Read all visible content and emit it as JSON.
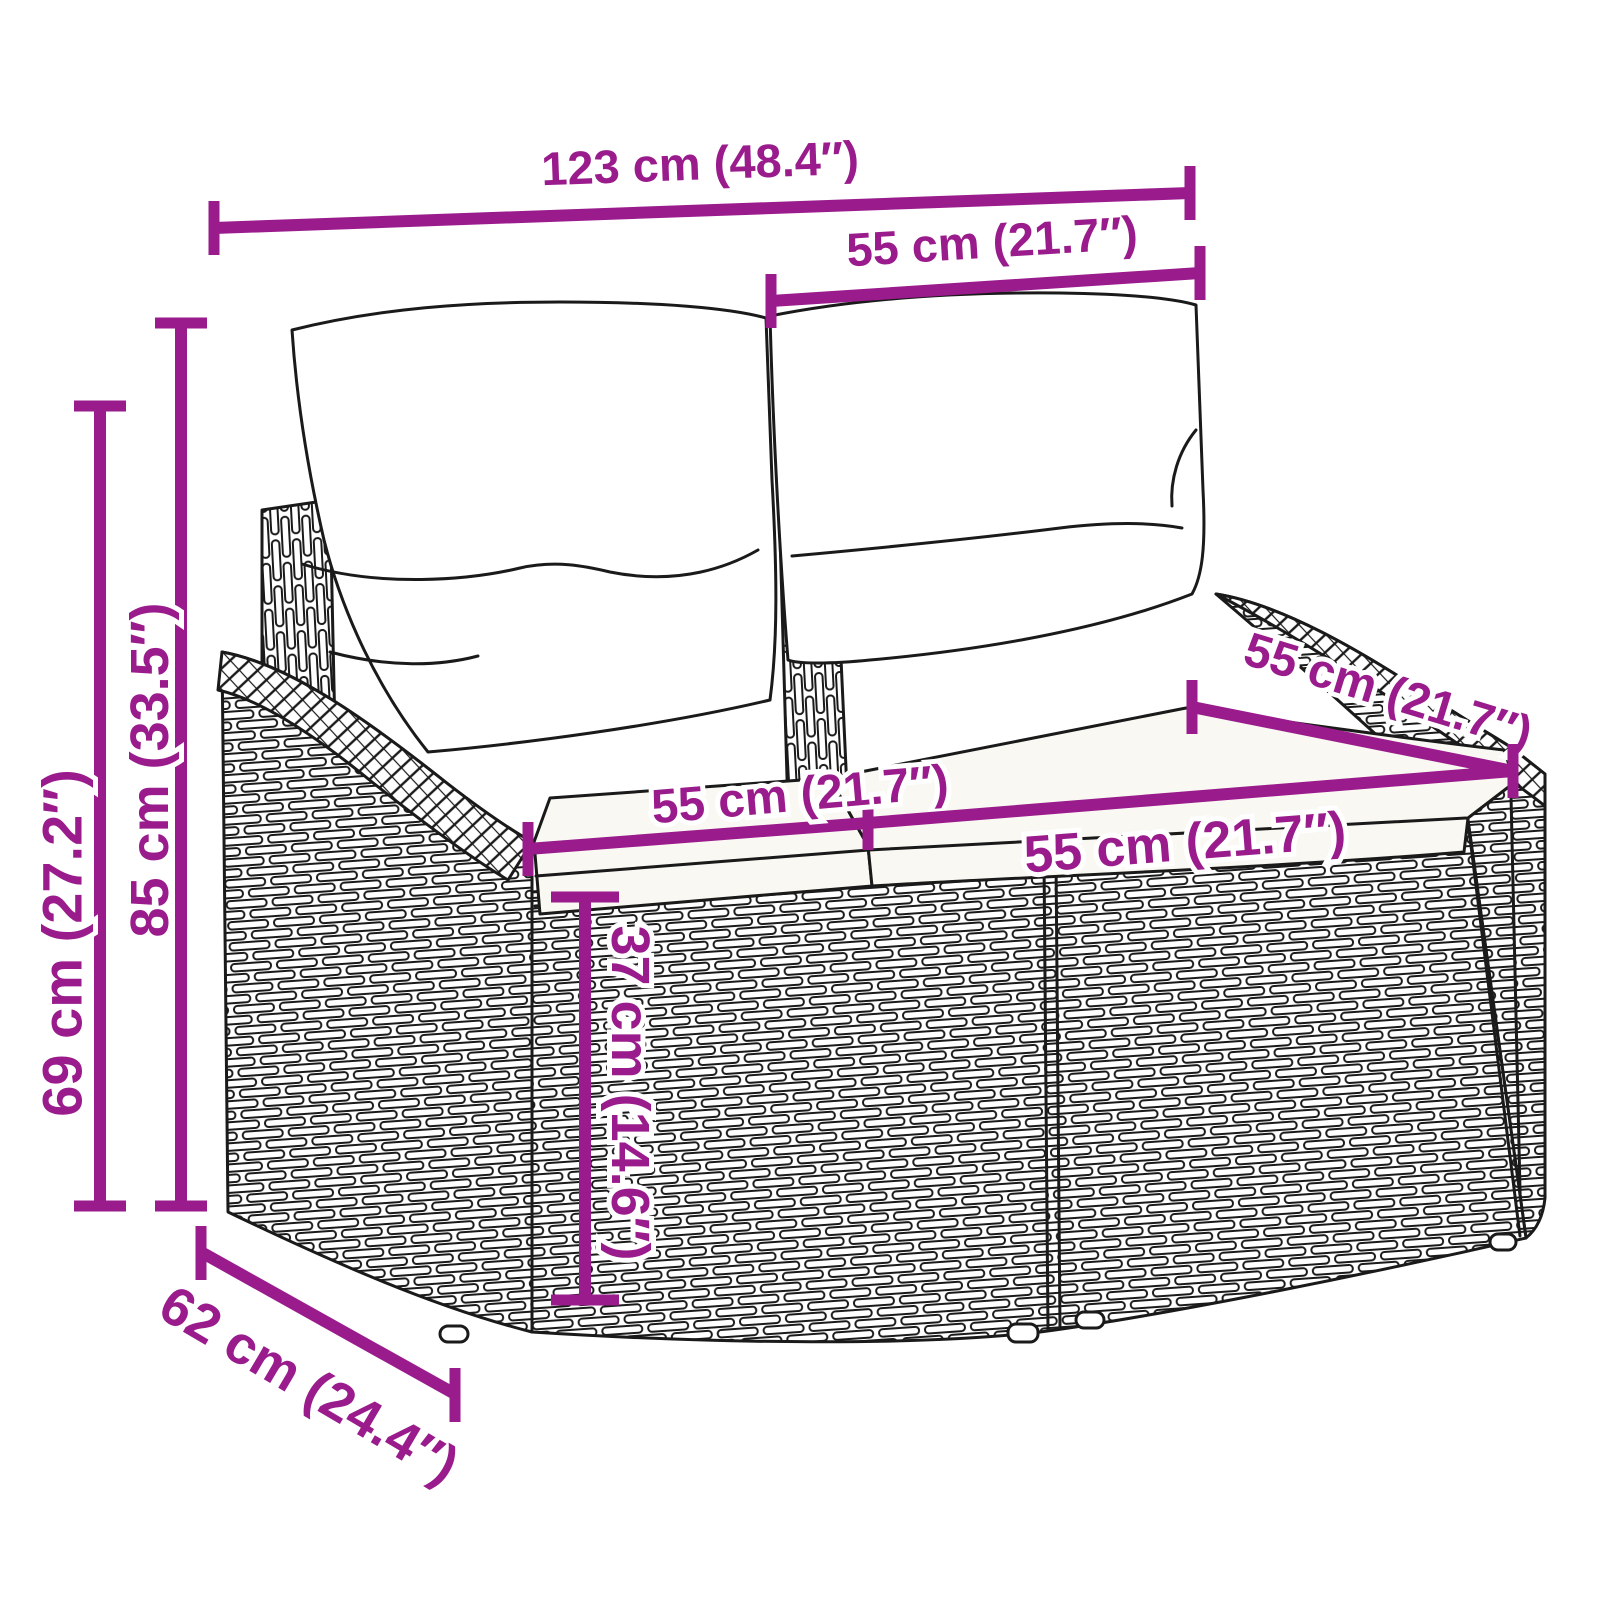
{
  "page": {
    "background": "#ffffff"
  },
  "style": {
    "accent_color": "#9A1B8C",
    "line_color": "#1a1a1a"
  },
  "diagram": {
    "type": "product-dimension-diagram",
    "subject": "2-seater poly rattan garden sofa with back and seat cushions",
    "dimensions": {
      "overall_width": "123 cm (48.4″)",
      "back_cushion_width": "55 cm (21.7″)",
      "seat_depth": "55 cm (21.7″)",
      "left_seat_width": "55 cm (21.7″)",
      "right_seat_width": "55 cm (21.7″)",
      "total_height": "85 cm (33.5″)",
      "armrest_height": "69 cm (27.2″)",
      "seat_front_height": "37 cm (14.6″)",
      "overall_depth": "62 cm (24.4″)"
    }
  }
}
